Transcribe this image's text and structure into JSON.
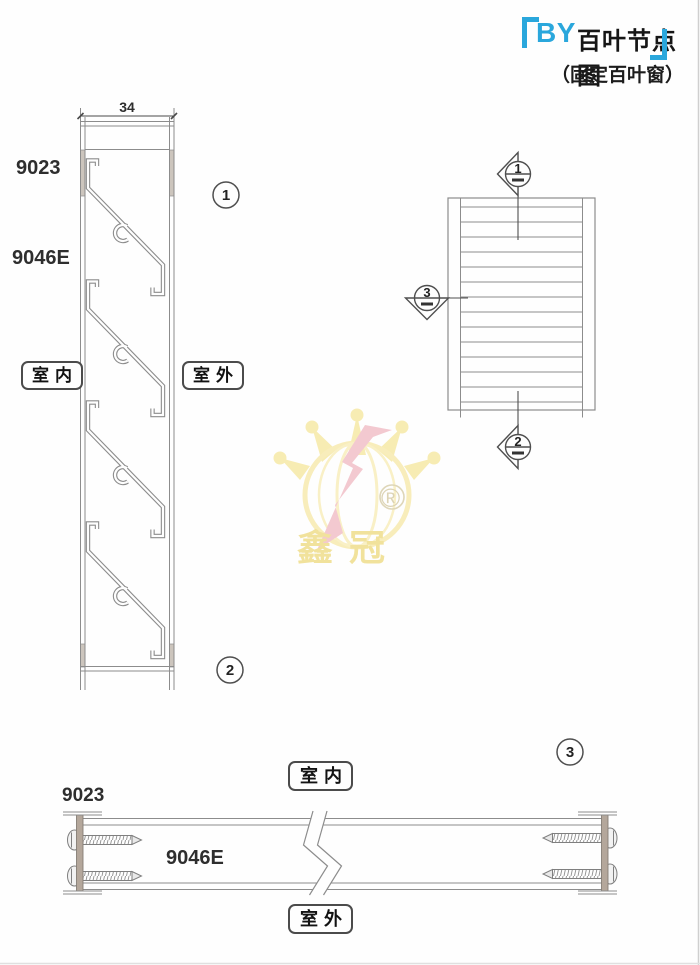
{
  "title": {
    "prefix": "BY",
    "name": "百叶节点图",
    "subtitle": "（固定百叶窗）"
  },
  "vertical_section": {
    "dimension": "34",
    "frame_profile": "9023",
    "louver_profile": "9046E",
    "indoor": "室内",
    "outdoor": "室外",
    "detail_top": "1",
    "detail_bottom": "2"
  },
  "plan_view": {
    "marker_top": "1",
    "marker_bottom": "2",
    "marker_left": "3"
  },
  "horizontal_section": {
    "frame_profile": "9023",
    "louver_profile": "9046E",
    "indoor": "室内",
    "outdoor": "室外",
    "detail": "3"
  },
  "watermark": {
    "brand": "鑫冠",
    "registered": "®"
  },
  "colors": {
    "accent_blue": "#2aa7dc",
    "line_gray": "#8c8c8c",
    "marker_gray": "#4f4f4f",
    "mullion_fill": "#b4a79b",
    "watermark_yellow": "#f7ecb3",
    "watermark_pink": "#f3c9d0"
  }
}
